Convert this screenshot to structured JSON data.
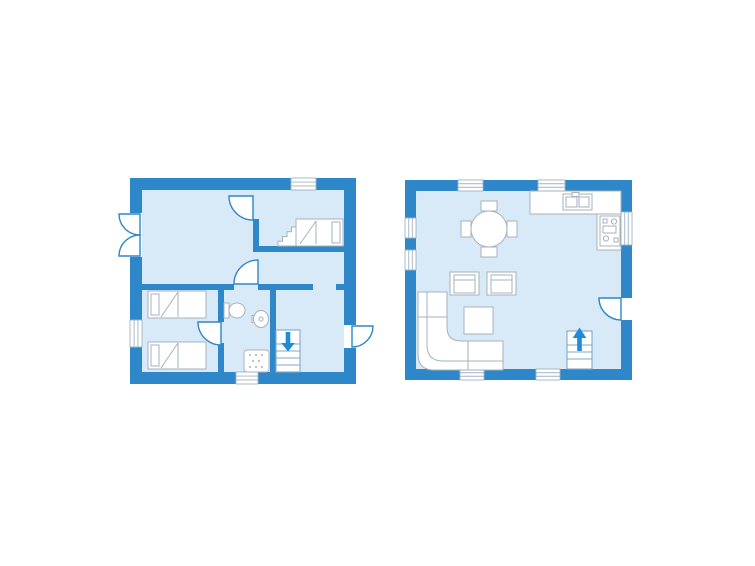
{
  "canvas": {
    "width": 755,
    "height": 566
  },
  "colors": {
    "wall": "#2E87C8",
    "room": "#D8E9F8",
    "accent": "#1E8BD8",
    "furniture_fill": "#FFFFFF",
    "furniture_stroke": "#A7B2BC",
    "stairs_stroke": "#7FA8C8",
    "window_stroke": "#9FB4C4",
    "background": "#FFFFFF"
  },
  "floors": [
    {
      "name": "upper-floor-plan",
      "elements": [
        {
          "name": "outer-wall",
          "type": "base",
          "x": 130,
          "y": 178,
          "w": 226,
          "h": 206
        },
        {
          "name": "floor-area",
          "type": "room",
          "x": 142,
          "y": 190,
          "w": 202,
          "h": 182
        },
        {
          "name": "interior-wall",
          "type": "wall",
          "x": 253,
          "y": 219,
          "w": 6,
          "h": 33
        },
        {
          "name": "interior-wall",
          "type": "wall",
          "x": 259,
          "y": 246,
          "w": 85,
          "h": 6
        },
        {
          "name": "interior-wall",
          "type": "wall",
          "x": 142,
          "y": 284,
          "w": 92,
          "h": 6
        },
        {
          "name": "interior-wall",
          "type": "wall",
          "x": 258,
          "y": 284,
          "w": 55,
          "h": 6
        },
        {
          "name": "interior-wall",
          "type": "wall",
          "x": 336,
          "y": 284,
          "w": 8,
          "h": 6
        },
        {
          "name": "interior-wall",
          "type": "wall",
          "x": 218,
          "y": 290,
          "w": 6,
          "h": 32
        },
        {
          "name": "interior-wall",
          "type": "wall",
          "x": 218,
          "y": 343,
          "w": 6,
          "h": 29
        },
        {
          "name": "interior-wall",
          "type": "wall",
          "x": 270,
          "y": 290,
          "w": 6,
          "h": 82
        },
        {
          "name": "window",
          "type": "window",
          "x": 291,
          "y": 178,
          "w": 25,
          "h": 12,
          "orient": "h"
        },
        {
          "name": "window",
          "type": "window",
          "x": 130,
          "y": 320,
          "w": 12,
          "h": 27,
          "orient": "v"
        },
        {
          "name": "window",
          "type": "window",
          "x": 236,
          "y": 372,
          "w": 22,
          "h": 12,
          "orient": "h"
        },
        {
          "name": "door-opening",
          "type": "gap",
          "x": 130,
          "y": 213,
          "w": 12,
          "h": 44
        },
        {
          "name": "door-opening",
          "type": "gap",
          "x": 344,
          "y": 325,
          "w": 12,
          "h": 23
        },
        {
          "name": "french-door-leaf",
          "type": "door",
          "corner": "tr",
          "x": 140,
          "y": 214,
          "r": 21
        },
        {
          "name": "french-door-leaf",
          "type": "door",
          "corner": "br",
          "x": 140,
          "y": 256,
          "r": 21
        },
        {
          "name": "door-swing",
          "type": "door",
          "corner": "tr",
          "x": 253,
          "y": 196,
          "r": 24
        },
        {
          "name": "door-swing",
          "type": "door",
          "corner": "br",
          "x": 258,
          "y": 284,
          "r": 24
        },
        {
          "name": "door-swing",
          "type": "door",
          "corner": "tr",
          "x": 221,
          "y": 322,
          "r": 23
        },
        {
          "name": "entrance-door-swing",
          "type": "door",
          "corner": "tl",
          "x": 352,
          "y": 326,
          "r": 21
        },
        {
          "name": "staircase-down",
          "type": "stairs",
          "x": 276,
          "y": 330,
          "w": 24,
          "h": 42,
          "arrow": "down"
        },
        {
          "name": "single-bed",
          "type": "bed",
          "x": 296,
          "y": 219,
          "w": 47,
          "h": 27,
          "pillow": "right"
        },
        {
          "name": "bed-steps",
          "type": "steps",
          "x": 278,
          "y": 227,
          "w": 18,
          "h": 19
        },
        {
          "name": "single-bed",
          "type": "bed",
          "x": 148,
          "y": 291,
          "w": 58,
          "h": 27,
          "pillow": "left"
        },
        {
          "name": "single-bed",
          "type": "bed",
          "x": 148,
          "y": 342,
          "w": 58,
          "h": 27,
          "pillow": "left"
        },
        {
          "name": "toilet",
          "type": "toilet",
          "x": 224,
          "y": 302
        },
        {
          "name": "washbasin",
          "type": "sink",
          "cx": 261,
          "cy": 319
        },
        {
          "name": "shower",
          "type": "shower",
          "x": 244,
          "y": 350,
          "w": 25,
          "h": 22
        }
      ]
    },
    {
      "name": "ground-floor-plan",
      "elements": [
        {
          "name": "outer-wall",
          "type": "base",
          "x": 405,
          "y": 180,
          "w": 227,
          "h": 200
        },
        {
          "name": "floor-area",
          "type": "room",
          "x": 416,
          "y": 191,
          "w": 205,
          "h": 178
        },
        {
          "name": "window",
          "type": "window",
          "x": 458,
          "y": 180,
          "w": 25,
          "h": 11,
          "orient": "h"
        },
        {
          "name": "window",
          "type": "window",
          "x": 538,
          "y": 180,
          "w": 27,
          "h": 11,
          "orient": "h"
        },
        {
          "name": "window",
          "type": "window",
          "x": 405,
          "y": 218,
          "w": 11,
          "h": 20,
          "orient": "v"
        },
        {
          "name": "window",
          "type": "window",
          "x": 405,
          "y": 250,
          "w": 11,
          "h": 20,
          "orient": "v"
        },
        {
          "name": "window",
          "type": "window",
          "x": 460,
          "y": 369,
          "w": 24,
          "h": 11,
          "orient": "h"
        },
        {
          "name": "window",
          "type": "window",
          "x": 536,
          "y": 369,
          "w": 24,
          "h": 11,
          "orient": "h"
        },
        {
          "name": "window",
          "type": "window",
          "x": 621,
          "y": 212,
          "w": 11,
          "h": 33,
          "orient": "v"
        },
        {
          "name": "door-opening",
          "type": "gap",
          "x": 621,
          "y": 298,
          "w": 11,
          "h": 22
        },
        {
          "name": "entrance-door-swing",
          "type": "door",
          "corner": "tr",
          "x": 621,
          "y": 298,
          "r": 22
        },
        {
          "name": "kitchen-counter",
          "type": "counter",
          "x": 530,
          "y": 191,
          "w": 91,
          "h": 23
        },
        {
          "name": "kitchen-counter",
          "type": "counter",
          "x": 597,
          "y": 214,
          "w": 24,
          "h": 36
        },
        {
          "name": "kitchen-sink",
          "type": "ksink",
          "x": 563,
          "y": 194,
          "w": 29,
          "h": 16
        },
        {
          "name": "stove",
          "type": "stove",
          "x": 600,
          "y": 216,
          "w": 20,
          "h": 30
        },
        {
          "name": "dining-table",
          "type": "table",
          "cx": 489,
          "cy": 229,
          "r": 18
        },
        {
          "name": "armchair",
          "type": "armchair",
          "x": 450,
          "y": 272,
          "w": 29,
          "h": 23
        },
        {
          "name": "armchair",
          "type": "armchair",
          "x": 487,
          "y": 272,
          "w": 29,
          "h": 23
        },
        {
          "name": "coffee-table",
          "type": "ctable",
          "x": 464,
          "y": 307,
          "w": 29,
          "h": 27
        },
        {
          "name": "corner-sofa",
          "type": "sofa",
          "x": 418,
          "y": 292,
          "w": 85,
          "h": 78,
          "arm": 29,
          "r": 14
        },
        {
          "name": "staircase-up",
          "type": "stairs",
          "x": 567,
          "y": 331,
          "w": 25,
          "h": 38,
          "arrow": "up"
        }
      ]
    }
  ]
}
